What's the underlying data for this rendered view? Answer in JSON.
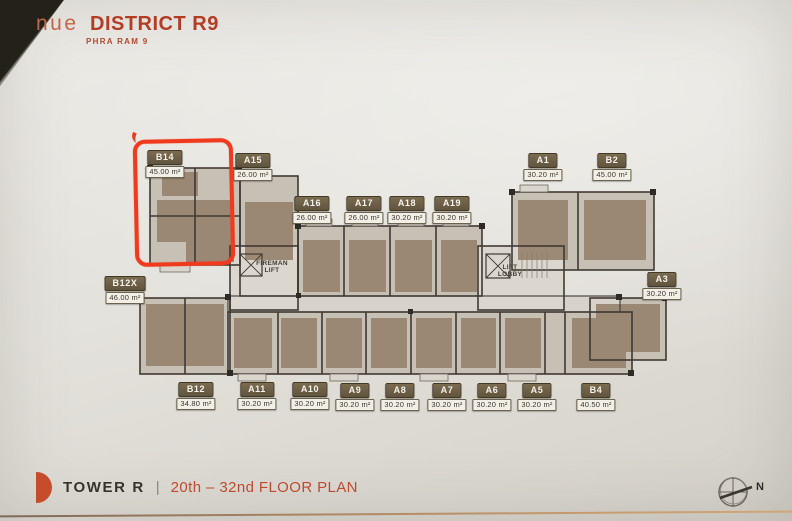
{
  "header": {
    "brand_light": "nue",
    "brand_bold": "DISTRICT R9",
    "subtitle": "PHRA RAM 9"
  },
  "plan": {
    "fireman_lift_label": "FIREMAN\nLIFT",
    "lift_lobby_label": "LIFT\nLOBBY",
    "highlighted_unit": "B14",
    "units": [
      {
        "id": "B14",
        "area": "45.00 m²",
        "x": 165,
        "y": 150,
        "highlighted": true
      },
      {
        "id": "A15",
        "area": "26.00 m²",
        "x": 253,
        "y": 153,
        "highlighted": false
      },
      {
        "id": "A16",
        "area": "26.00 m²",
        "x": 312,
        "y": 196,
        "highlighted": false
      },
      {
        "id": "A17",
        "area": "26.00 m²",
        "x": 364,
        "y": 196,
        "highlighted": false
      },
      {
        "id": "A18",
        "area": "30.20 m²",
        "x": 407,
        "y": 196,
        "highlighted": false
      },
      {
        "id": "A19",
        "area": "30.20 m²",
        "x": 452,
        "y": 196,
        "highlighted": false
      },
      {
        "id": "A1",
        "area": "30.20 m²",
        "x": 543,
        "y": 153,
        "highlighted": false
      },
      {
        "id": "B2",
        "area": "45.00 m²",
        "x": 612,
        "y": 153,
        "highlighted": false
      },
      {
        "id": "B12X",
        "area": "46.00 m²",
        "x": 125,
        "y": 276,
        "highlighted": false
      },
      {
        "id": "A3",
        "area": "30.20 m²",
        "x": 662,
        "y": 272,
        "highlighted": false
      },
      {
        "id": "B12",
        "area": "34.80 m²",
        "x": 196,
        "y": 382,
        "highlighted": false
      },
      {
        "id": "A11",
        "area": "30.20 m²",
        "x": 257,
        "y": 382,
        "highlighted": false
      },
      {
        "id": "A10",
        "area": "30.20 m²",
        "x": 310,
        "y": 382,
        "highlighted": false
      },
      {
        "id": "A9",
        "area": "30.20 m²",
        "x": 355,
        "y": 383,
        "highlighted": false
      },
      {
        "id": "A8",
        "area": "30.20 m²",
        "x": 400,
        "y": 383,
        "highlighted": false
      },
      {
        "id": "A7",
        "area": "30.20 m²",
        "x": 447,
        "y": 383,
        "highlighted": false
      },
      {
        "id": "A6",
        "area": "30.20 m²",
        "x": 492,
        "y": 383,
        "highlighted": false
      },
      {
        "id": "A5",
        "area": "30.20 m²",
        "x": 537,
        "y": 383,
        "highlighted": false
      },
      {
        "id": "B4",
        "area": "40.50 m²",
        "x": 596,
        "y": 383,
        "highlighted": false
      }
    ]
  },
  "footer": {
    "tower": "TOWER R",
    "separator": "|",
    "floor_range": "20th – 32nd FLOOR PLAN"
  },
  "compass": {
    "label": "N"
  },
  "colors": {
    "accent": "#bf4a2e",
    "badge_bg": "#6d5f46",
    "highlight_red": "#ef3a1e",
    "paper": "#e4e2dc"
  }
}
